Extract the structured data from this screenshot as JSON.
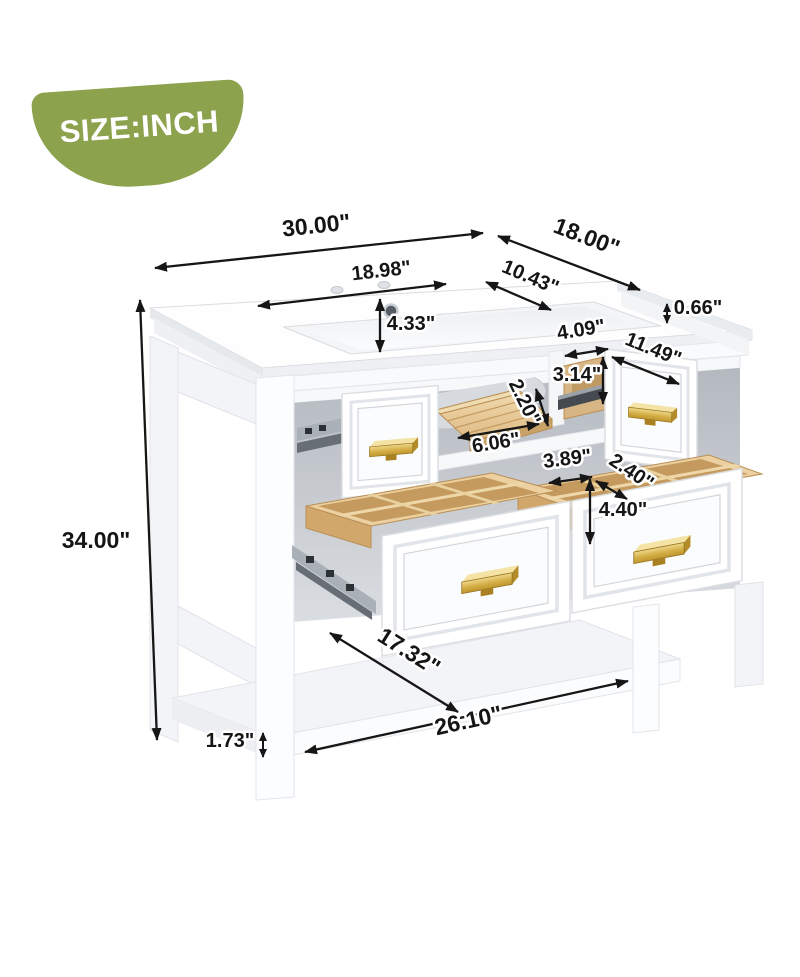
{
  "badge": {
    "label": "SIZE:INCH",
    "bg_color": "#8CA24C",
    "text_color": "#FFFFFF"
  },
  "dimensions": {
    "overall_width": "30.00\"",
    "overall_depth": "18.00\"",
    "overall_height": "34.00\"",
    "sink_width": "18.98\"",
    "sink_depth": "10.43\"",
    "sink_bowl_depth": "4.33\"",
    "countertop_thickness": "0.66\"",
    "opening_width": "4.09\"",
    "opening_height": "3.14\"",
    "top_drawer_depth": "11.49\"",
    "tray_height": "2.20\"",
    "tray_width": "6.06\"",
    "compartment_width": "3.89\"",
    "compartment_depth": "2.40\"",
    "bottom_drawer_height": "4.40\"",
    "shelf_depth": "17.32\"",
    "shelf_width": "26.10\"",
    "shelf_thickness": "1.73\""
  },
  "colors": {
    "badge_green": "#8CA24C",
    "wood_light": "#EFD6A8",
    "wood_dark": "#C49A5E",
    "gold_handle": "#D4AE45",
    "dimension_line": "#161616"
  }
}
